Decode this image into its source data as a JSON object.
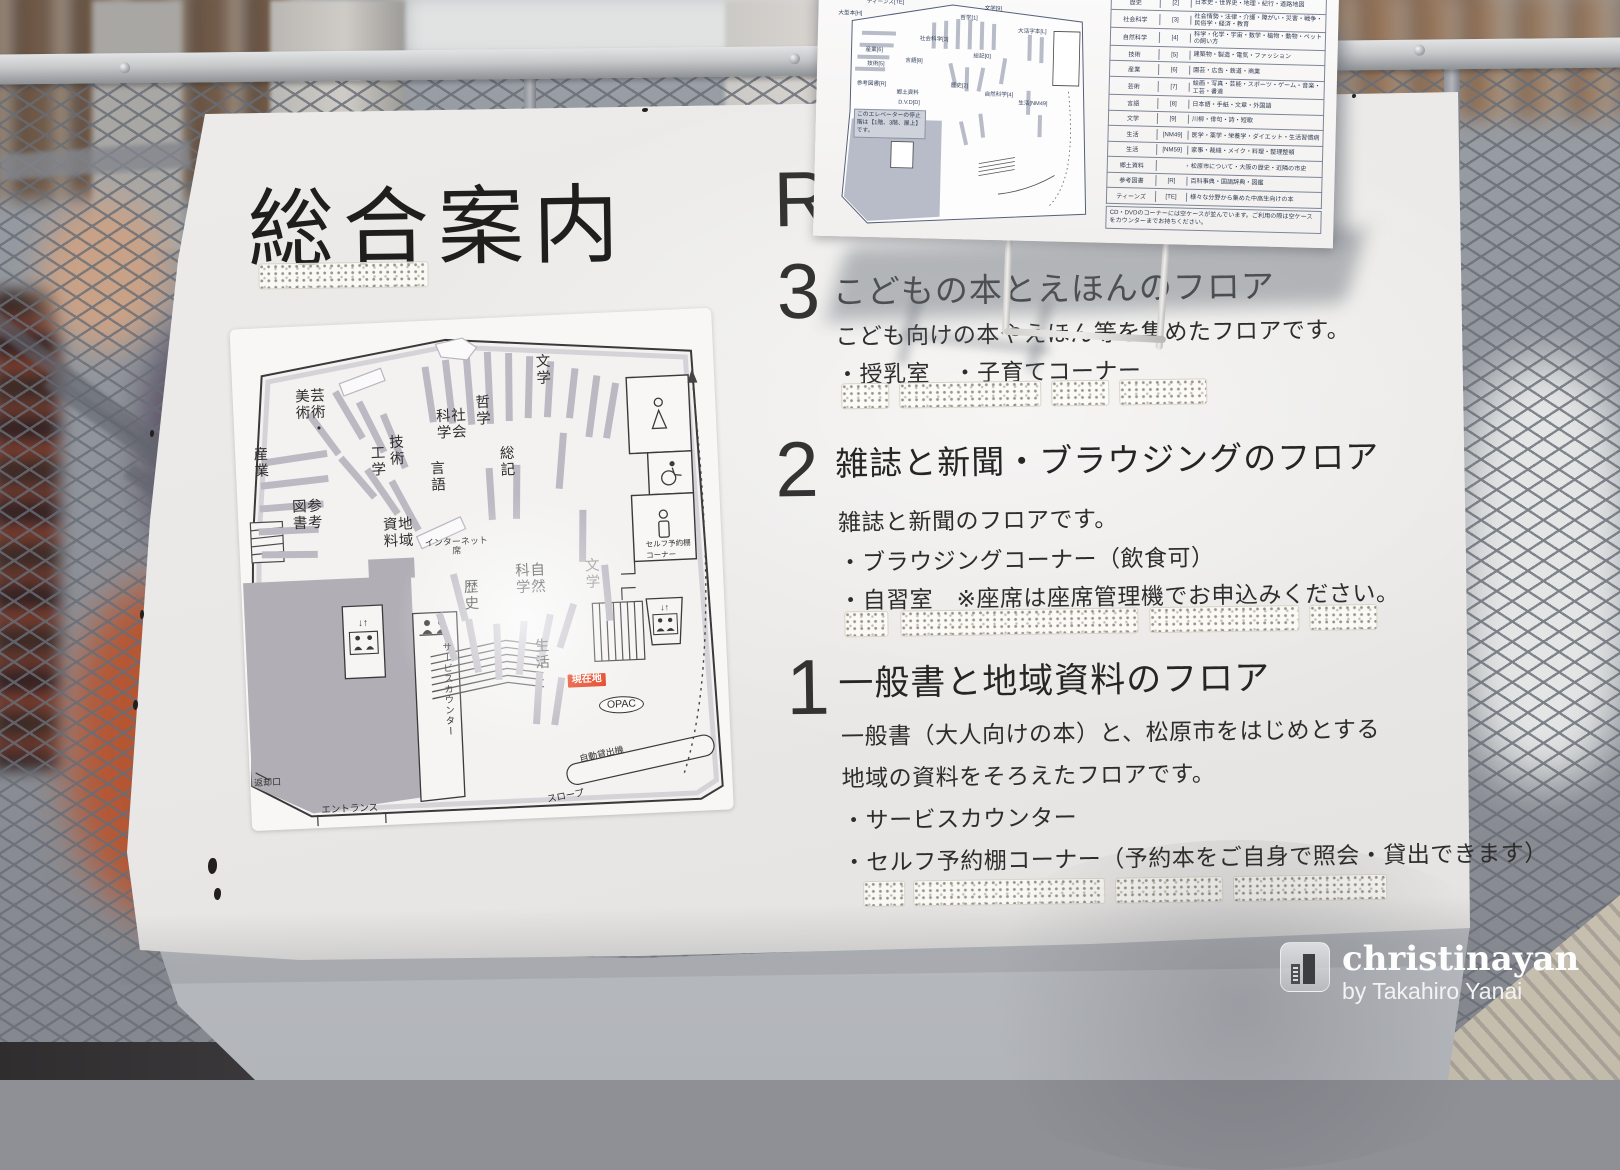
{
  "sign": {
    "title": "総合案内",
    "floors": [
      {
        "number": "R"
      },
      {
        "number": "3",
        "heading": "こどもの本とえほんのフロア",
        "desc": [
          "こども向けの本やえほん等を集めたフロアです。"
        ],
        "bullets": [
          "・授乳室　・子育てコーナー"
        ]
      },
      {
        "number": "2",
        "heading": "雑誌と新聞・ブラウジングのフロア",
        "desc": [
          "雑誌と新聞のフロアです。"
        ],
        "bullets": [
          "・ブラウジングコーナー（飲食可）",
          "・自習室　※座席は座席管理機でお申込みください。"
        ]
      },
      {
        "number": "1",
        "heading": "一般書と地域資料のフロア",
        "desc": [
          "一般書（大人向けの本）と、松原市をはじめとする",
          "地域の資料をそろえたフロアです。"
        ],
        "bullets": [
          "・サービスカウンター",
          "・セルフ予約棚コーナー（予約本をご自身で照会・貸出できます）"
        ]
      }
    ],
    "map": {
      "labels": {
        "art": "芸術・美術",
        "literature_top": "文学",
        "philosophy": "哲学",
        "social_science": "社会科学",
        "industry": "産業",
        "reference": "参考図書",
        "technology": "技術",
        "engineering": "工学",
        "language": "言語",
        "local_materials": "地域資料",
        "internet": "インターネット席",
        "general": "総記",
        "history": "歴史",
        "natural_science": "自然科学",
        "literature_center": "文学",
        "life": "生活",
        "service_counter": "サービスカウンター",
        "you_are_here": "現在地",
        "opac": "OPAC",
        "self_checkout": "自動貸出機",
        "slope": "スロープ",
        "entrance": "エントランス",
        "returns": "返却口",
        "self_shelf": "セルフ予約棚コーナー",
        "ev_arrows": "↓↑"
      }
    }
  },
  "paper": {
    "map_note": "このエレベーターの停止階は【1階、3階、屋上】です。",
    "mini_labels": [
      "ティーンズ[TE]",
      "大型本[H]",
      "参考図書[R]",
      "産業[6]",
      "技術[5]",
      "社会科学[3]",
      "言語[8]",
      "郷土資料",
      "D.V.D[D]",
      "哲学[1]",
      "文学[9]",
      "大活字本[L]",
      "総記[0]",
      "歴史[2]",
      "自然科学[4]",
      "生活[NM49]"
    ],
    "table": {
      "rows": [
        {
          "genre": "歴史",
          "code": "[2]",
          "desc": "日本史・世界史・地理・紀行・道路地図"
        },
        {
          "genre": "社会科学",
          "code": "[3]",
          "desc": "社会情勢・法律・介護・障がい・災害・戦争・民俗学・経済・教育"
        },
        {
          "genre": "自然科学",
          "code": "[4]",
          "desc": "科学・化学・宇宙・数学・植物・動物・ペットの飼い方"
        },
        {
          "genre": "技術",
          "code": "[5]",
          "desc": "建築物・製造・電気・ファッション"
        },
        {
          "genre": "産業",
          "code": "[6]",
          "desc": "園芸・広告・鉄道・商業"
        },
        {
          "genre": "芸術",
          "code": "[7]",
          "desc": "絵画・写真・芸能・スポーツ・ゲーム・音楽・工芸・書道"
        },
        {
          "genre": "言語",
          "code": "[8]",
          "desc": "日本語・手紙・文章・外国語"
        },
        {
          "genre": "文学",
          "code": "[9]",
          "desc": "川柳・俳句・詩・短歌"
        },
        {
          "genre": "生活",
          "code": "[NM49]",
          "desc": "医学・薬学・栄養学・ダイエット・生活習慣病"
        },
        {
          "genre": "生活",
          "code": "[NM59]",
          "desc": "家事・裁縫・メイク・料理・整理整頓"
        },
        {
          "genre": "郷土資料",
          "code": "",
          "desc": "松原市について・大阪の歴史・近隣の市史"
        },
        {
          "genre": "参考図書",
          "code": "[R]",
          "desc": "百科事典・国語辞典・図鑑"
        },
        {
          "genre": "ティーンズ",
          "code": "[TE]",
          "desc": "様々な分野から集めた中高生向けの本"
        }
      ],
      "note": "CD・DVDのコーナーには空ケースが並んでいます。ご利用の際は空ケースをカウンターまでお持ちください。"
    }
  },
  "watermark": {
    "brand": "christinayan",
    "byline": "by Takahiro Yanai"
  },
  "colors": {
    "accent_red": "#e23a17",
    "sign_white": "#edecea",
    "stack_grey": "#bdb9c3",
    "closed_area": "#b2aeb6"
  }
}
